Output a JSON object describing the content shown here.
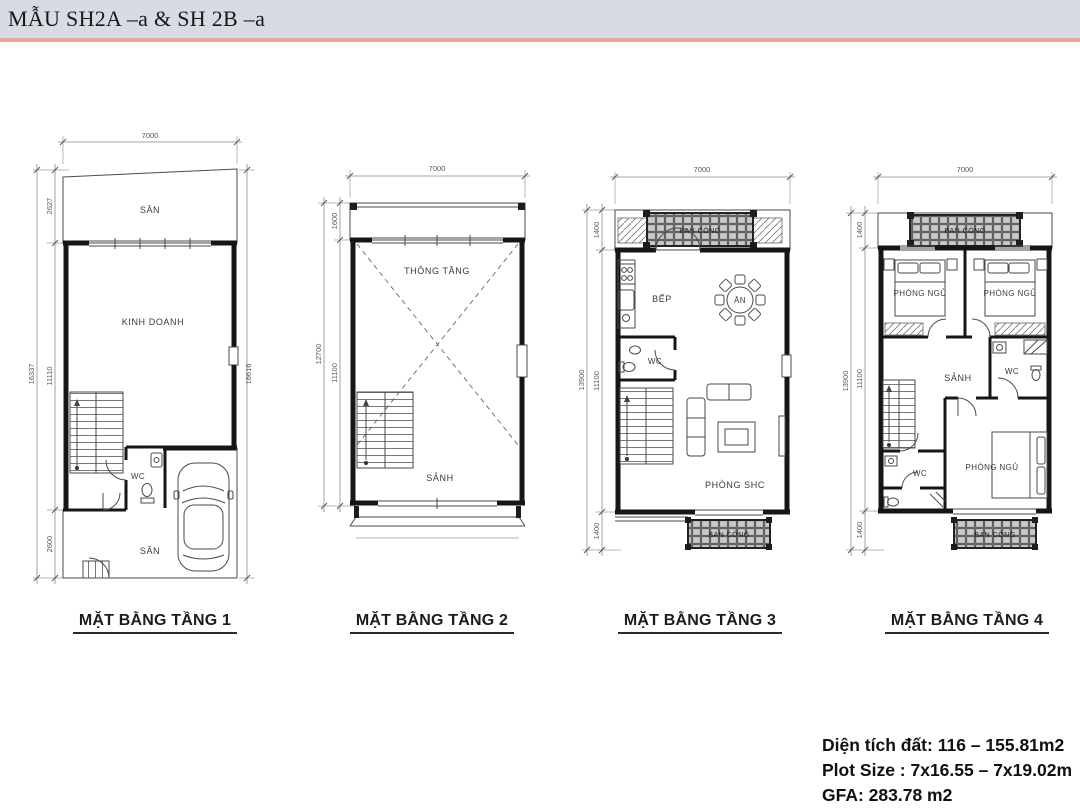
{
  "header": {
    "title": "MẪU SH2A –a  & SH 2B –a"
  },
  "colors": {
    "header_bar": "#d9dbe3",
    "accent_line": "#eba79a",
    "wall": "#161616",
    "dim_text": "#5a5a5a"
  },
  "plans": [
    {
      "title": "MẶT BẰNG TẦNG 1",
      "dims": {
        "top": "7000",
        "overall_left": "16337",
        "left_segments": [
          "2627",
          "11110",
          "2600"
        ],
        "overall_right": "16616"
      },
      "rooms": {
        "san_top": "SÂN",
        "main": "KINH DOANH",
        "wc": "WC",
        "san_bottom": "SÂN"
      }
    },
    {
      "title": "MẶT BẰNG TẦNG 2",
      "dims": {
        "top": "7000",
        "overall_left": "12700",
        "left_segments": [
          "1600",
          "11100"
        ]
      },
      "rooms": {
        "void": "THÔNG TẦNG",
        "hall": "SẢNH"
      }
    },
    {
      "title": "MẶT BẰNG TẦNG 3",
      "dims": {
        "top": "7000",
        "overall_left": "13900",
        "left_segments": [
          "1400",
          "11100",
          "1400"
        ]
      },
      "rooms": {
        "balcony_top": "BAN CÔNG",
        "kitchen": "BẾP",
        "dining": "ĂN",
        "wc": "WC",
        "living": "PHÒNG SHC",
        "balcony_bottom": "BAN CÔNG"
      }
    },
    {
      "title": "MẶT BẰNG TẦNG 4",
      "dims": {
        "top": "7000",
        "overall_left": "13900",
        "left_segments": [
          "1400",
          "11100",
          "1400"
        ]
      },
      "rooms": {
        "balcony_top": "BAN CÔNG",
        "bedroom_left": "PHÒNG NGỦ",
        "bedroom_right": "PHÒNG NGỦ",
        "hall": "SẢNH",
        "wc_top": "WC",
        "wc_bottom": "WC",
        "bedroom_bottom": "PHÒNG NGỦ",
        "balcony_bottom": "BAN CÔNG"
      }
    }
  ],
  "info": {
    "area": "Diện tích đất: 116 – 155.81m2",
    "plot": "Plot Size : 7x16.55 – 7x19.02m",
    "gfa": "GFA: 283.78 m2"
  }
}
